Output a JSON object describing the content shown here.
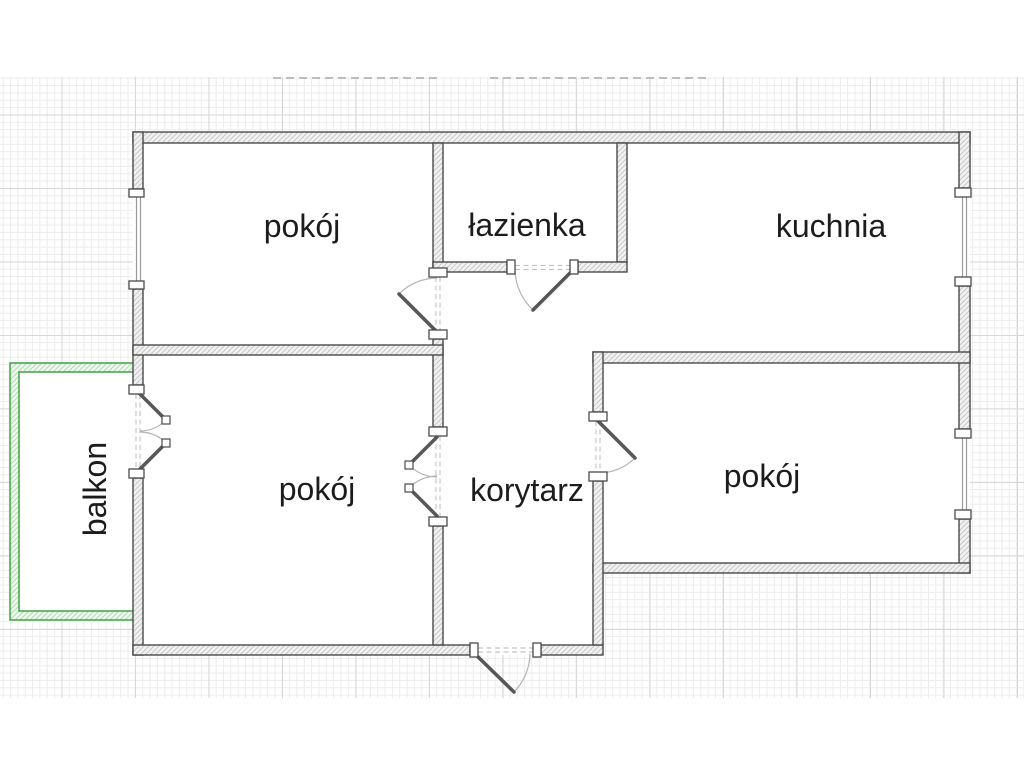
{
  "rooms": [
    {
      "key": "room_top_left",
      "label": "pokój"
    },
    {
      "key": "bathroom",
      "label": "łazienka"
    },
    {
      "key": "kitchen",
      "label": "kuchnia"
    },
    {
      "key": "room_bottom_left",
      "label": "pokój"
    },
    {
      "key": "corridor",
      "label": "korytarz"
    },
    {
      "key": "room_bottom_right",
      "label": "pokój"
    },
    {
      "key": "balcony",
      "label": "balkon"
    }
  ],
  "colors": {
    "wall_outline": "#4a4a4a",
    "wall_fill": "#f2f2f2",
    "balcony_outline": "#44a044",
    "label_text": "#1c1c1c",
    "grid_minor": "#ececec",
    "grid_major": "#d7d7d7"
  }
}
